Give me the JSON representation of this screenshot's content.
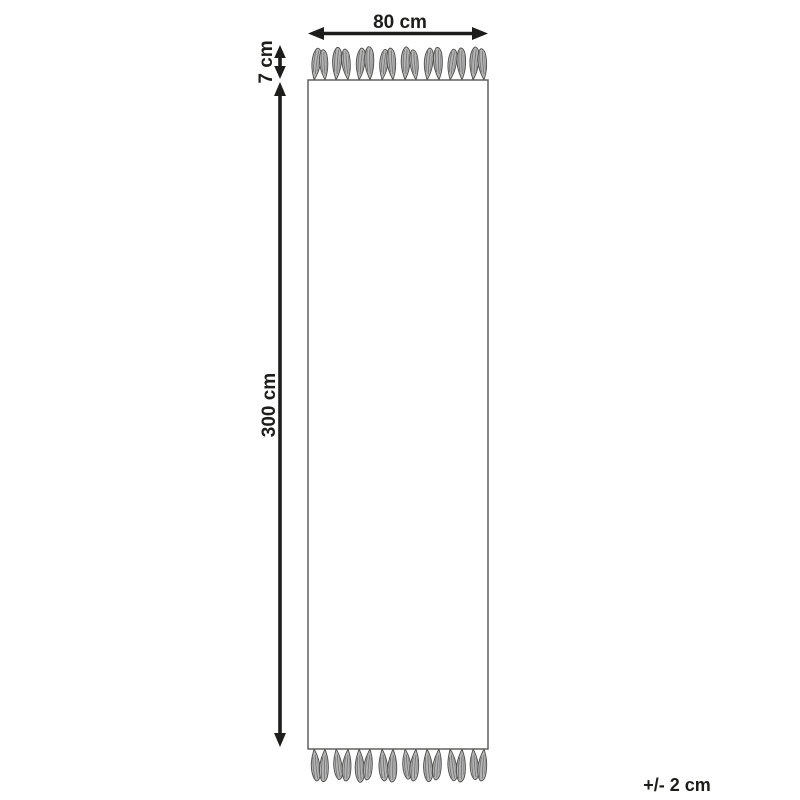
{
  "diagram": {
    "kind": "rug-dimension-diagram",
    "subject": "runner rug with fringe tassels on both short ends",
    "labels": {
      "width": "80 cm",
      "fringe_height": "7 cm",
      "length": "300 cm",
      "tolerance": "+/- 2 cm"
    },
    "colors": {
      "background": "#ffffff",
      "arrow": "#1d1d1b",
      "label_text": "#1d1d1b",
      "rug_outline": "#555553",
      "rug_fill": "#ffffff",
      "tassel_fill": "#b4b4b4",
      "tassel_outline": "#4d4d4b",
      "tassel_shade": "#6e6e6e"
    }
  }
}
